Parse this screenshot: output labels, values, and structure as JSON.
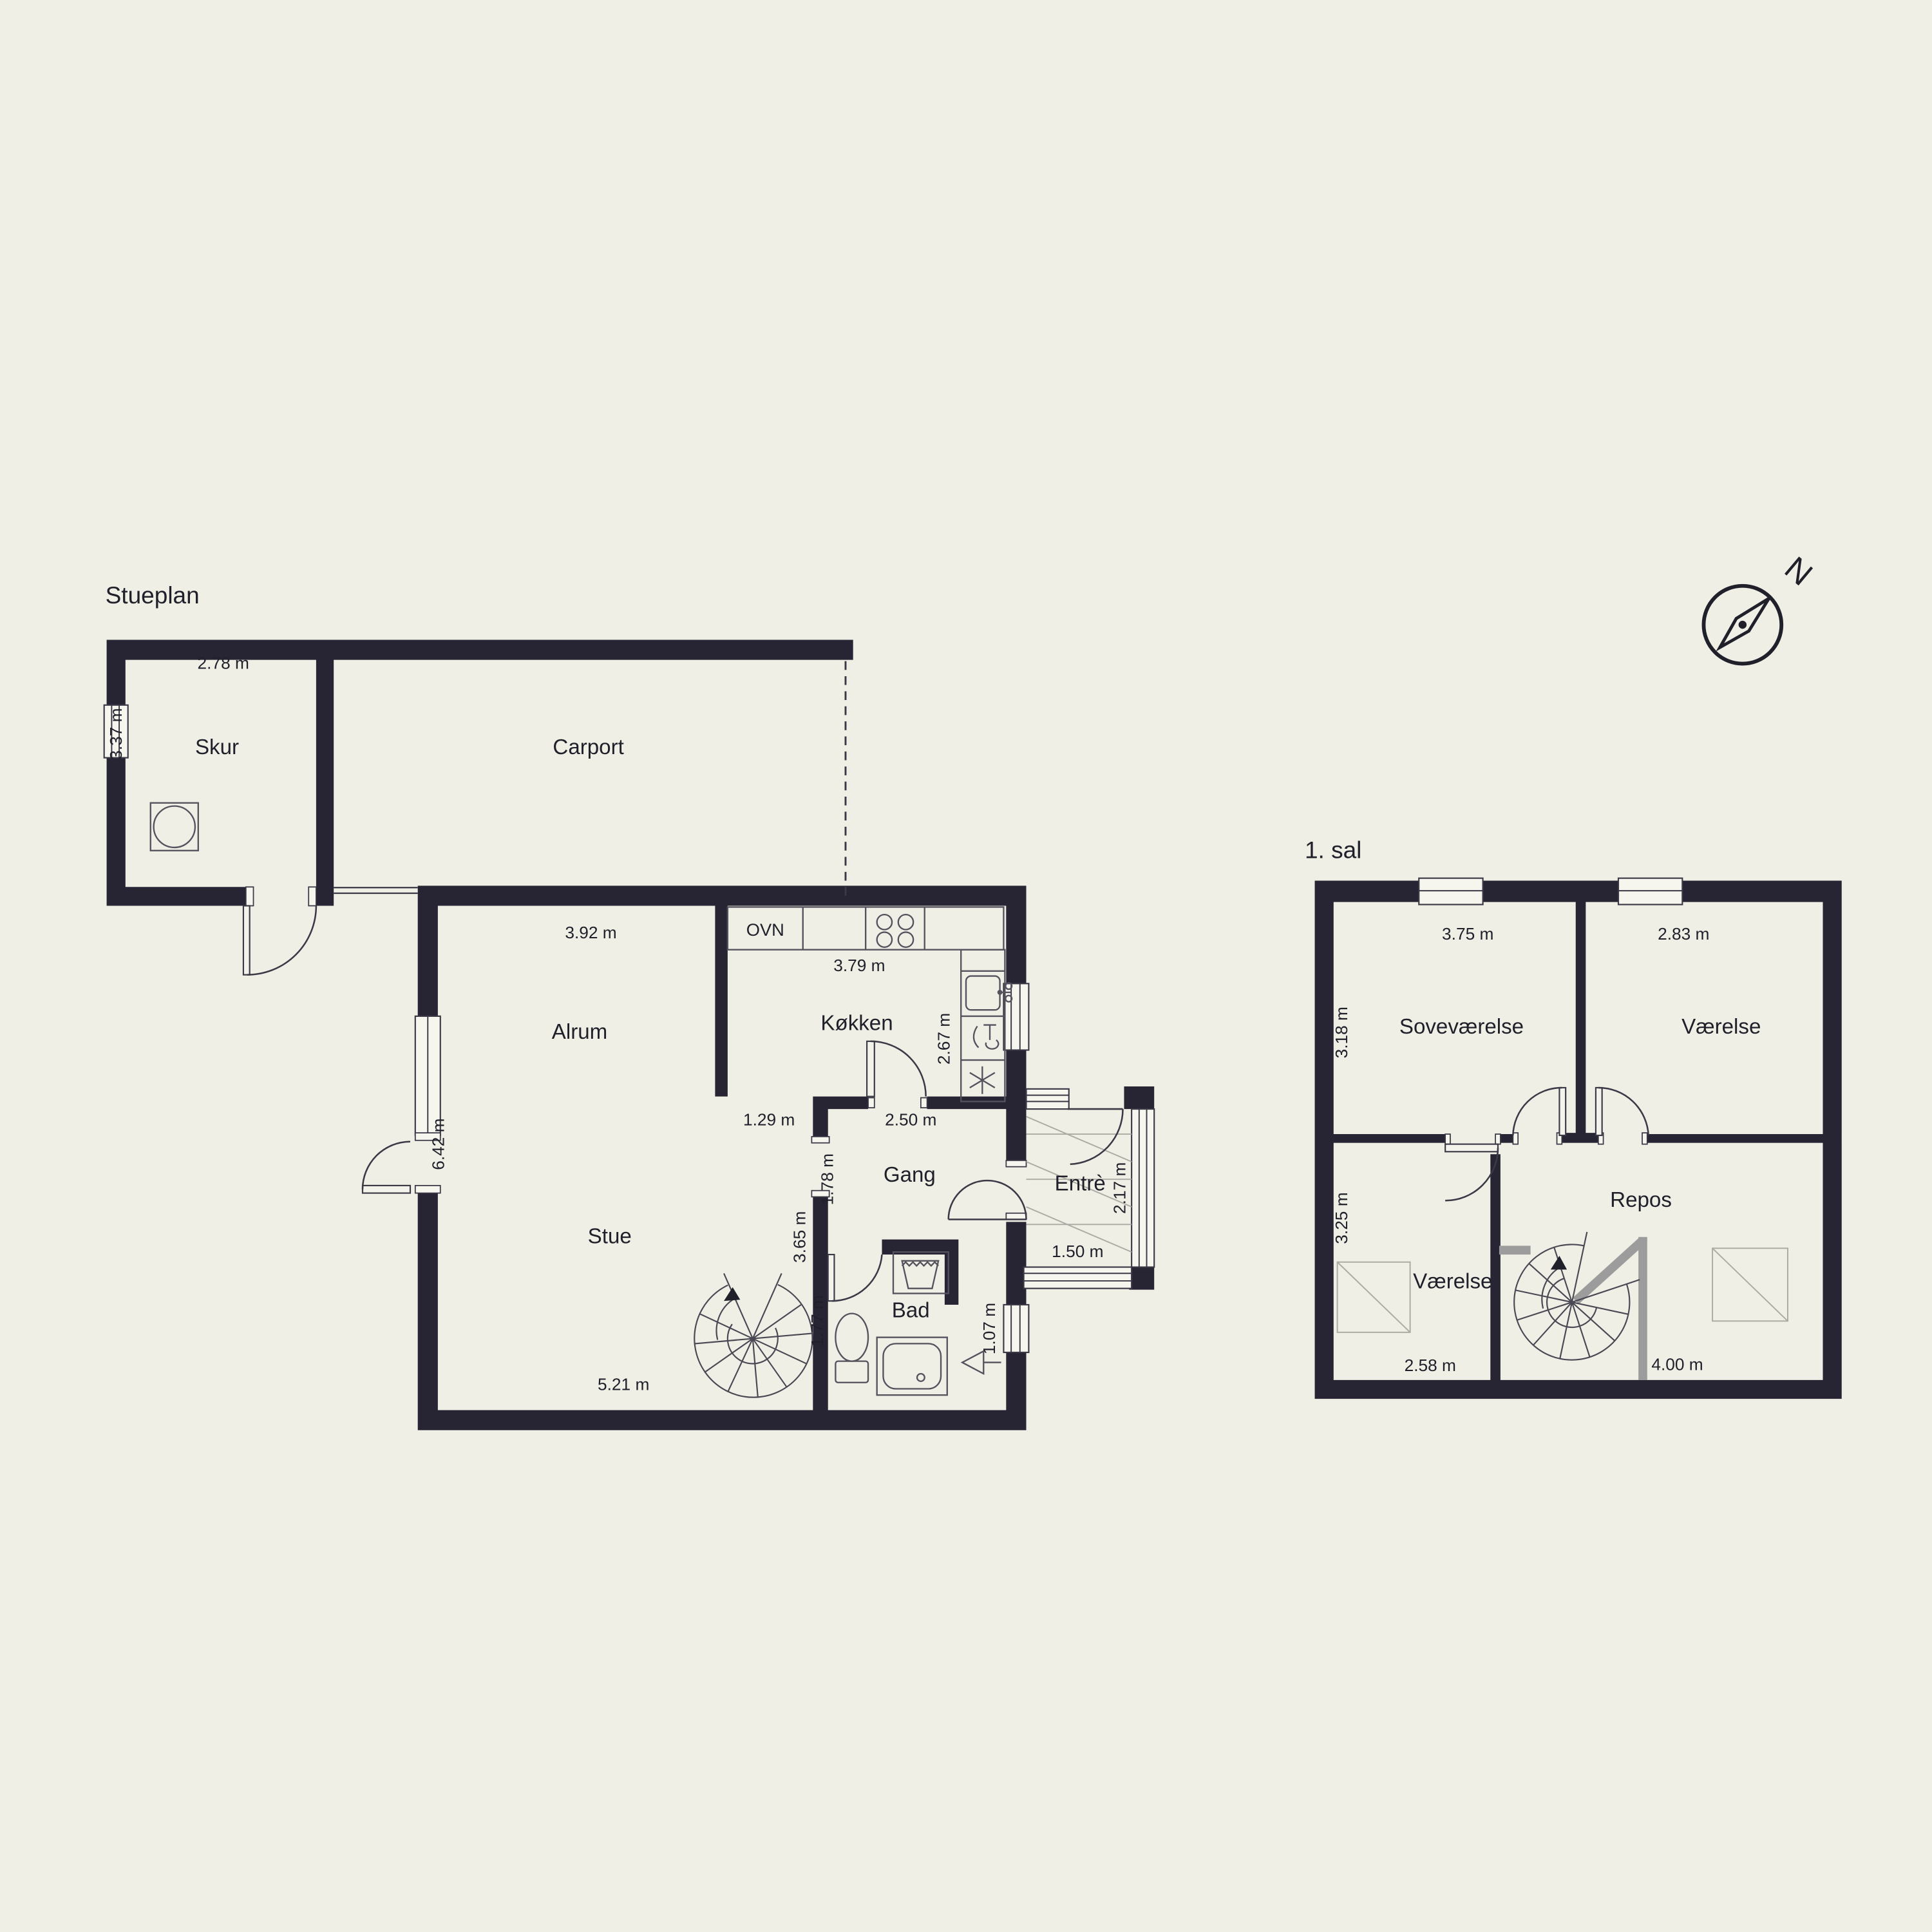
{
  "colors": {
    "background": "#EFEFE6",
    "wall": "#272433",
    "line": "#3B3946",
    "railing": "#9C9C9C",
    "text": "#20202B"
  },
  "ground": {
    "title": "Stueplan",
    "labels": {
      "skur": "Skur",
      "carport": "Carport",
      "alrum": "Alrum",
      "ovn": "OVN",
      "kokken": "Køkken",
      "gang": "Gang",
      "stue": "Stue",
      "bad": "Bad",
      "entre": "Entrè"
    },
    "dims": {
      "d278": "2.78 m",
      "d337": "3.37 m",
      "d392": "3.92 m",
      "d379": "3.79 m",
      "d267": "2.67 m",
      "d642": "6.42 m",
      "d129": "1.29 m",
      "d250": "2.50 m",
      "d178": "1.78 m",
      "d365": "3.65 m",
      "d177": "1.77 m",
      "d521": "5.21 m",
      "d107": "1.07 m",
      "d217": "2.17 m",
      "d150": "1.50 m"
    }
  },
  "first": {
    "title": "1. sal",
    "labels": {
      "sovevaerelse": "Soveværelse",
      "vaerelse_top": "Værelse",
      "vaerelse_bottom": "Værelse",
      "repos": "Repos"
    },
    "dims": {
      "d375": "3.75 m",
      "d283": "2.83 m",
      "d318": "3.18 m",
      "d325": "3.25 m",
      "d258": "2.58 m",
      "d400": "4.00 m"
    }
  },
  "compass": {
    "north": "N"
  }
}
